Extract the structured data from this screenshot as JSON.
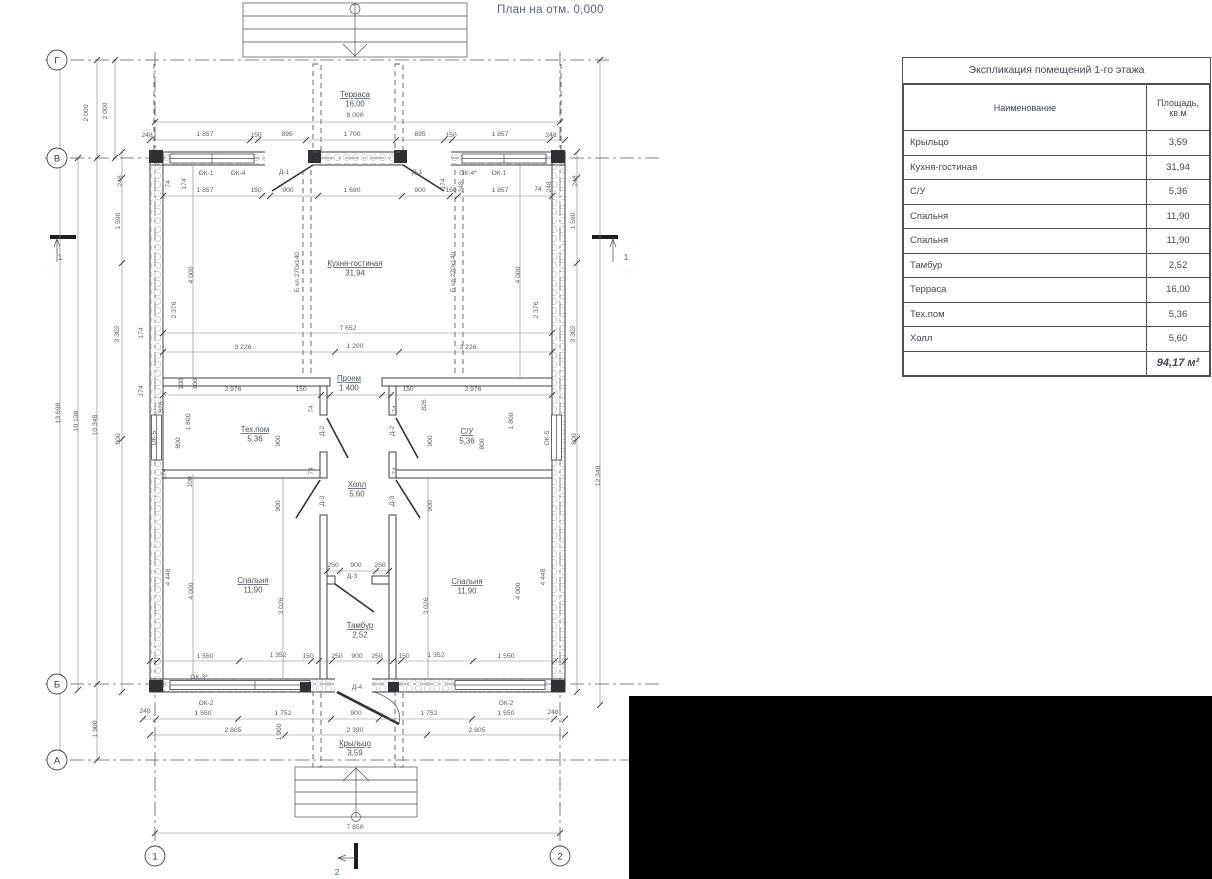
{
  "page": {
    "title": "План на отм. 0,000"
  },
  "table": {
    "title": "Экспликация помещений 1-го этажа",
    "columns": [
      "Наименование",
      "Площадь, кв.м"
    ],
    "rows": [
      [
        "Крыльцо",
        "3,59"
      ],
      [
        "Кухня-гостиная",
        "31,94"
      ],
      [
        "С/У",
        "5,36"
      ],
      [
        "Спальня",
        "11,90"
      ],
      [
        "Спальня",
        "11,90"
      ],
      [
        "Тамбур",
        "2,52"
      ],
      [
        "Терраса",
        "16,00"
      ],
      [
        "Тех.пом",
        "5,36"
      ],
      [
        "Холл",
        "5,60"
      ]
    ],
    "total": "94,17 м²"
  },
  "plan": {
    "axis_circles": [
      {
        "x": 57,
        "y": 60,
        "label": "Г"
      },
      {
        "x": 57,
        "y": 158,
        "label": "В"
      },
      {
        "x": 57,
        "y": 684,
        "label": "Б"
      },
      {
        "x": 57,
        "y": 760,
        "label": "А"
      },
      {
        "x": 155,
        "y": 856,
        "label": "1"
      },
      {
        "x": 560,
        "y": 856,
        "label": "2"
      }
    ],
    "rooms": [
      {
        "x": 355,
        "y": 97,
        "name": "Терраса",
        "area": "16,00"
      },
      {
        "x": 355,
        "y": 266,
        "name": "Кухня-гостиная",
        "area": "31,94"
      },
      {
        "x": 255,
        "y": 432,
        "name": "Тех.пом",
        "area": "5,36"
      },
      {
        "x": 467,
        "y": 434,
        "name": "С/У",
        "area": "5,36"
      },
      {
        "x": 357,
        "y": 487,
        "name": "Холл",
        "area": "5,60"
      },
      {
        "x": 253,
        "y": 583,
        "name": "Спальня",
        "area": "11,90"
      },
      {
        "x": 467,
        "y": 584,
        "name": "Спальня",
        "area": "11,90"
      },
      {
        "x": 360,
        "y": 628,
        "name": "Тамбур",
        "area": "2,52"
      },
      {
        "x": 355,
        "y": 746,
        "name": "Крыльцо",
        "area": "3,59"
      },
      {
        "x": 349,
        "y": 381,
        "name": "Проем",
        "area": "1 400"
      }
    ],
    "labels": [
      {
        "x": 355,
        "y": 117,
        "t": "8 000"
      },
      {
        "x": 147,
        "y": 137,
        "t": "248"
      },
      {
        "x": 205,
        "y": 136,
        "t": "1 857"
      },
      {
        "x": 256,
        "y": 137,
        "t": "150"
      },
      {
        "x": 287,
        "y": 136,
        "t": "895"
      },
      {
        "x": 352,
        "y": 136,
        "t": "1 700"
      },
      {
        "x": 420,
        "y": 136,
        "t": "895"
      },
      {
        "x": 451,
        "y": 137,
        "t": "150"
      },
      {
        "x": 500,
        "y": 136,
        "t": "1 857"
      },
      {
        "x": 551,
        "y": 137,
        "t": "248"
      },
      {
        "x": 205,
        "y": 192,
        "t": "1 857"
      },
      {
        "x": 256,
        "y": 192,
        "t": "150"
      },
      {
        "x": 288,
        "y": 192,
        "t": "900"
      },
      {
        "x": 352,
        "y": 192,
        "t": "1 690"
      },
      {
        "x": 420,
        "y": 192,
        "t": "900"
      },
      {
        "x": 451,
        "y": 192,
        "t": "150"
      },
      {
        "x": 500,
        "y": 192,
        "t": "1 857"
      },
      {
        "x": 538,
        "y": 191,
        "t": "74"
      },
      {
        "x": 348,
        "y": 330,
        "t": "7 652"
      },
      {
        "x": 243,
        "y": 349,
        "t": "3 226"
      },
      {
        "x": 355,
        "y": 348,
        "t": "1 200"
      },
      {
        "x": 468,
        "y": 349,
        "t": "3 226"
      },
      {
        "x": 233,
        "y": 391,
        "t": "2 976"
      },
      {
        "x": 301,
        "y": 391,
        "t": "150"
      },
      {
        "x": 408,
        "y": 391,
        "t": "150"
      },
      {
        "x": 473,
        "y": 391,
        "t": "2 976"
      },
      {
        "x": 333,
        "y": 567,
        "t": "250"
      },
      {
        "x": 356,
        "y": 567,
        "t": "900"
      },
      {
        "x": 380,
        "y": 567,
        "t": "250"
      },
      {
        "x": 205,
        "y": 658,
        "t": "1 550"
      },
      {
        "x": 278,
        "y": 657,
        "t": "1 352"
      },
      {
        "x": 308,
        "y": 658,
        "t": "150"
      },
      {
        "x": 337,
        "y": 658,
        "t": "250"
      },
      {
        "x": 357,
        "y": 658,
        "t": "900"
      },
      {
        "x": 377,
        "y": 658,
        "t": "250"
      },
      {
        "x": 404,
        "y": 658,
        "t": "150"
      },
      {
        "x": 436,
        "y": 657,
        "t": "1 352"
      },
      {
        "x": 506,
        "y": 658,
        "t": "1 550"
      },
      {
        "x": 145,
        "y": 713,
        "t": "248"
      },
      {
        "x": 203,
        "y": 715,
        "t": "1 550"
      },
      {
        "x": 283,
        "y": 715,
        "t": "1 752"
      },
      {
        "x": 356,
        "y": 715,
        "t": "900"
      },
      {
        "x": 429,
        "y": 715,
        "t": "1 752"
      },
      {
        "x": 506,
        "y": 715,
        "t": "1 550"
      },
      {
        "x": 553,
        "y": 714,
        "t": "248"
      },
      {
        "x": 233,
        "y": 732,
        "t": "2 805"
      },
      {
        "x": 355,
        "y": 732,
        "t": "2 390"
      },
      {
        "x": 477,
        "y": 732,
        "t": "2 805"
      },
      {
        "x": 355,
        "y": 829,
        "t": "7 850"
      },
      {
        "x": 88,
        "y": 113,
        "t": "2 000",
        "v": 1
      },
      {
        "x": 107,
        "y": 111,
        "t": "2 000",
        "v": 1
      },
      {
        "x": 60,
        "y": 413,
        "t": "13 698",
        "v": 1
      },
      {
        "x": 78,
        "y": 421,
        "t": "10 198",
        "v": 1
      },
      {
        "x": 97,
        "y": 425,
        "t": "10 348",
        "v": 1
      },
      {
        "x": 97,
        "y": 729,
        "t": "1 900",
        "v": 1
      },
      {
        "x": 122,
        "y": 181,
        "t": "248",
        "v": 1
      },
      {
        "x": 120,
        "y": 221,
        "t": "1 590",
        "v": 1
      },
      {
        "x": 119,
        "y": 334,
        "t": "3 302",
        "v": 1
      },
      {
        "x": 120,
        "y": 439,
        "t": "800",
        "v": 1
      },
      {
        "x": 143,
        "y": 333,
        "t": "174",
        "v": 1
      },
      {
        "x": 143,
        "y": 391,
        "t": "174",
        "v": 1
      },
      {
        "x": 170,
        "y": 577,
        "t": "4 448",
        "v": 1
      },
      {
        "x": 170,
        "y": 184,
        "t": "74",
        "v": 1
      },
      {
        "x": 186,
        "y": 184,
        "t": "174",
        "v": 1
      },
      {
        "x": 445,
        "y": 184,
        "t": "174",
        "v": 1
      },
      {
        "x": 463,
        "y": 187,
        "t": "248",
        "v": 1
      },
      {
        "x": 551,
        "y": 187,
        "t": "248",
        "v": 1
      },
      {
        "x": 193,
        "y": 275,
        "t": "4 000",
        "v": 1
      },
      {
        "x": 176,
        "y": 310,
        "t": "2 376",
        "v": 1
      },
      {
        "x": 183,
        "y": 384,
        "t": "100",
        "v": 1
      },
      {
        "x": 197,
        "y": 384,
        "t": "100",
        "v": 1
      },
      {
        "x": 163,
        "y": 407,
        "t": "826",
        "v": 1
      },
      {
        "x": 190,
        "y": 422,
        "t": "1 800",
        "v": 1
      },
      {
        "x": 180,
        "y": 443,
        "t": "800",
        "v": 1
      },
      {
        "x": 166,
        "y": 474,
        "t": "174",
        "v": 1
      },
      {
        "x": 192,
        "y": 482,
        "t": "100",
        "v": 1
      },
      {
        "x": 193,
        "y": 591,
        "t": "4 000",
        "v": 1
      },
      {
        "x": 283,
        "y": 606,
        "t": "3 026",
        "v": 1
      },
      {
        "x": 281,
        "y": 732,
        "t": "1 900",
        "v": 1
      },
      {
        "x": 280,
        "y": 441,
        "t": "900",
        "v": 1
      },
      {
        "x": 432,
        "y": 441,
        "t": "900",
        "v": 1
      },
      {
        "x": 280,
        "y": 506,
        "t": "900",
        "v": 1
      },
      {
        "x": 432,
        "y": 506,
        "t": "900",
        "v": 1
      },
      {
        "x": 313,
        "y": 409,
        "t": "74",
        "v": 1
      },
      {
        "x": 313,
        "y": 471,
        "t": "74",
        "v": 1
      },
      {
        "x": 397,
        "y": 409,
        "t": "74",
        "v": 1
      },
      {
        "x": 397,
        "y": 471,
        "t": "74",
        "v": 1
      },
      {
        "x": 426,
        "y": 405,
        "t": "826",
        "v": 1
      },
      {
        "x": 513,
        "y": 421,
        "t": "1 800",
        "v": 1
      },
      {
        "x": 484,
        "y": 444,
        "t": "800",
        "v": 1
      },
      {
        "x": 538,
        "y": 310,
        "t": "2 376",
        "v": 1
      },
      {
        "x": 520,
        "y": 275,
        "t": "4 000",
        "v": 1
      },
      {
        "x": 520,
        "y": 591,
        "t": "4 000",
        "v": 1
      },
      {
        "x": 428,
        "y": 606,
        "t": "3 026",
        "v": 1
      },
      {
        "x": 545,
        "y": 577,
        "t": "4 448",
        "v": 1
      },
      {
        "x": 577,
        "y": 181,
        "t": "248",
        "v": 1
      },
      {
        "x": 575,
        "y": 221,
        "t": "1 590",
        "v": 1
      },
      {
        "x": 575,
        "y": 334,
        "t": "3 302",
        "v": 1
      },
      {
        "x": 576,
        "y": 439,
        "t": "800",
        "v": 1
      },
      {
        "x": 600,
        "y": 476,
        "t": "12 348",
        "v": 1
      },
      {
        "x": 206,
        "y": 175,
        "t": "ОК-1",
        "c": "tag"
      },
      {
        "x": 238,
        "y": 175,
        "t": "ОК-4",
        "c": "tag"
      },
      {
        "x": 284,
        "y": 174,
        "t": "Д-1",
        "c": "tag"
      },
      {
        "x": 417,
        "y": 174,
        "t": "Д-1",
        "c": "tag"
      },
      {
        "x": 468,
        "y": 175,
        "t": "ОК-4*",
        "c": "tag"
      },
      {
        "x": 499,
        "y": 175,
        "t": "ОК-1",
        "c": "tag"
      },
      {
        "x": 156,
        "y": 438,
        "t": "ОК-5",
        "v": 1,
        "c": "tag"
      },
      {
        "x": 549,
        "y": 438,
        "t": "ОК-5",
        "v": 1,
        "c": "tag"
      },
      {
        "x": 199,
        "y": 679,
        "t": "ОК-3*",
        "c": "tag"
      },
      {
        "x": 206,
        "y": 705,
        "t": "ОК-2",
        "c": "tag"
      },
      {
        "x": 506,
        "y": 705,
        "t": "ОК-2",
        "c": "tag"
      },
      {
        "x": 357,
        "y": 689,
        "t": "Д-4",
        "c": "tag"
      },
      {
        "x": 352,
        "y": 578,
        "t": "Д-3",
        "c": "tag"
      },
      {
        "x": 324,
        "y": 431,
        "t": "Д-2",
        "v": 1,
        "c": "tag"
      },
      {
        "x": 394,
        "y": 431,
        "t": "Д-2",
        "v": 1,
        "c": "tag"
      },
      {
        "x": 324,
        "y": 501,
        "t": "Д-3",
        "v": 1,
        "c": "tag"
      },
      {
        "x": 394,
        "y": 501,
        "t": "Д-3",
        "v": 1,
        "c": "tag"
      },
      {
        "x": 299,
        "y": 272,
        "t": "Б кл 270х140",
        "v": 1,
        "c": "tag"
      },
      {
        "x": 455,
        "y": 272,
        "t": "Б кл 270х140",
        "v": 1,
        "c": "tag"
      },
      {
        "x": 60,
        "y": 260,
        "t": "1",
        "c": "blue"
      },
      {
        "x": 626,
        "y": 260,
        "t": "1",
        "c": "blue"
      },
      {
        "x": 337,
        "y": 875,
        "t": "2",
        "c": "blue"
      }
    ]
  }
}
